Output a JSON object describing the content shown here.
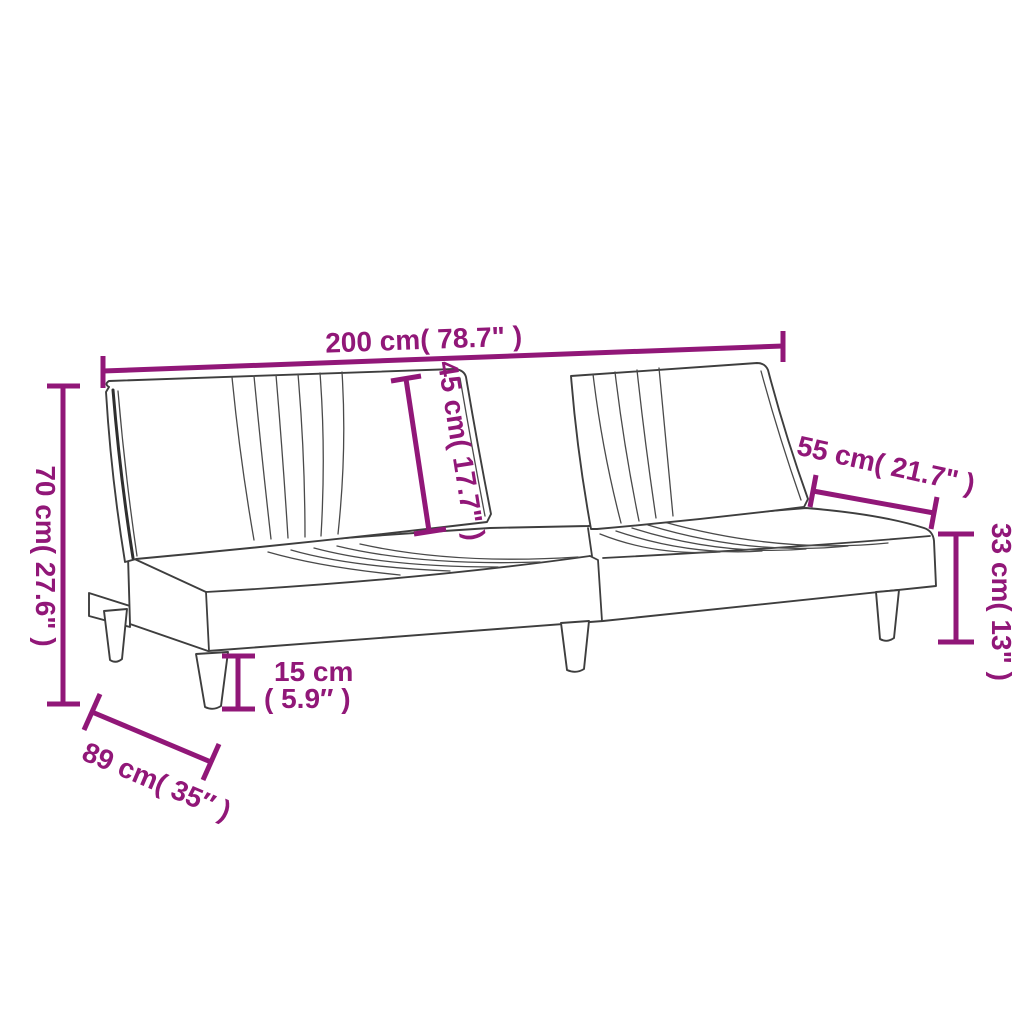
{
  "diagram": {
    "product": "sofa-bed-dimension-diagram",
    "background": "#ffffff",
    "accent_color": "#911778",
    "outline_color": "#3e3e3e",
    "dimensions": {
      "overall_width": "200 cm( 78.7\" )",
      "overall_height": "70 cm( 27.6\" )",
      "backrest_height": "45 cm( 17.7\" )",
      "seat_top_depth": "55 cm( 21.7\" )",
      "seat_height": "33 cm( 13\" )",
      "leg_height_value": "15 cm",
      "leg_height_inches": "( 5.9″ )",
      "overall_depth": "89 cm( 35″ )"
    }
  }
}
